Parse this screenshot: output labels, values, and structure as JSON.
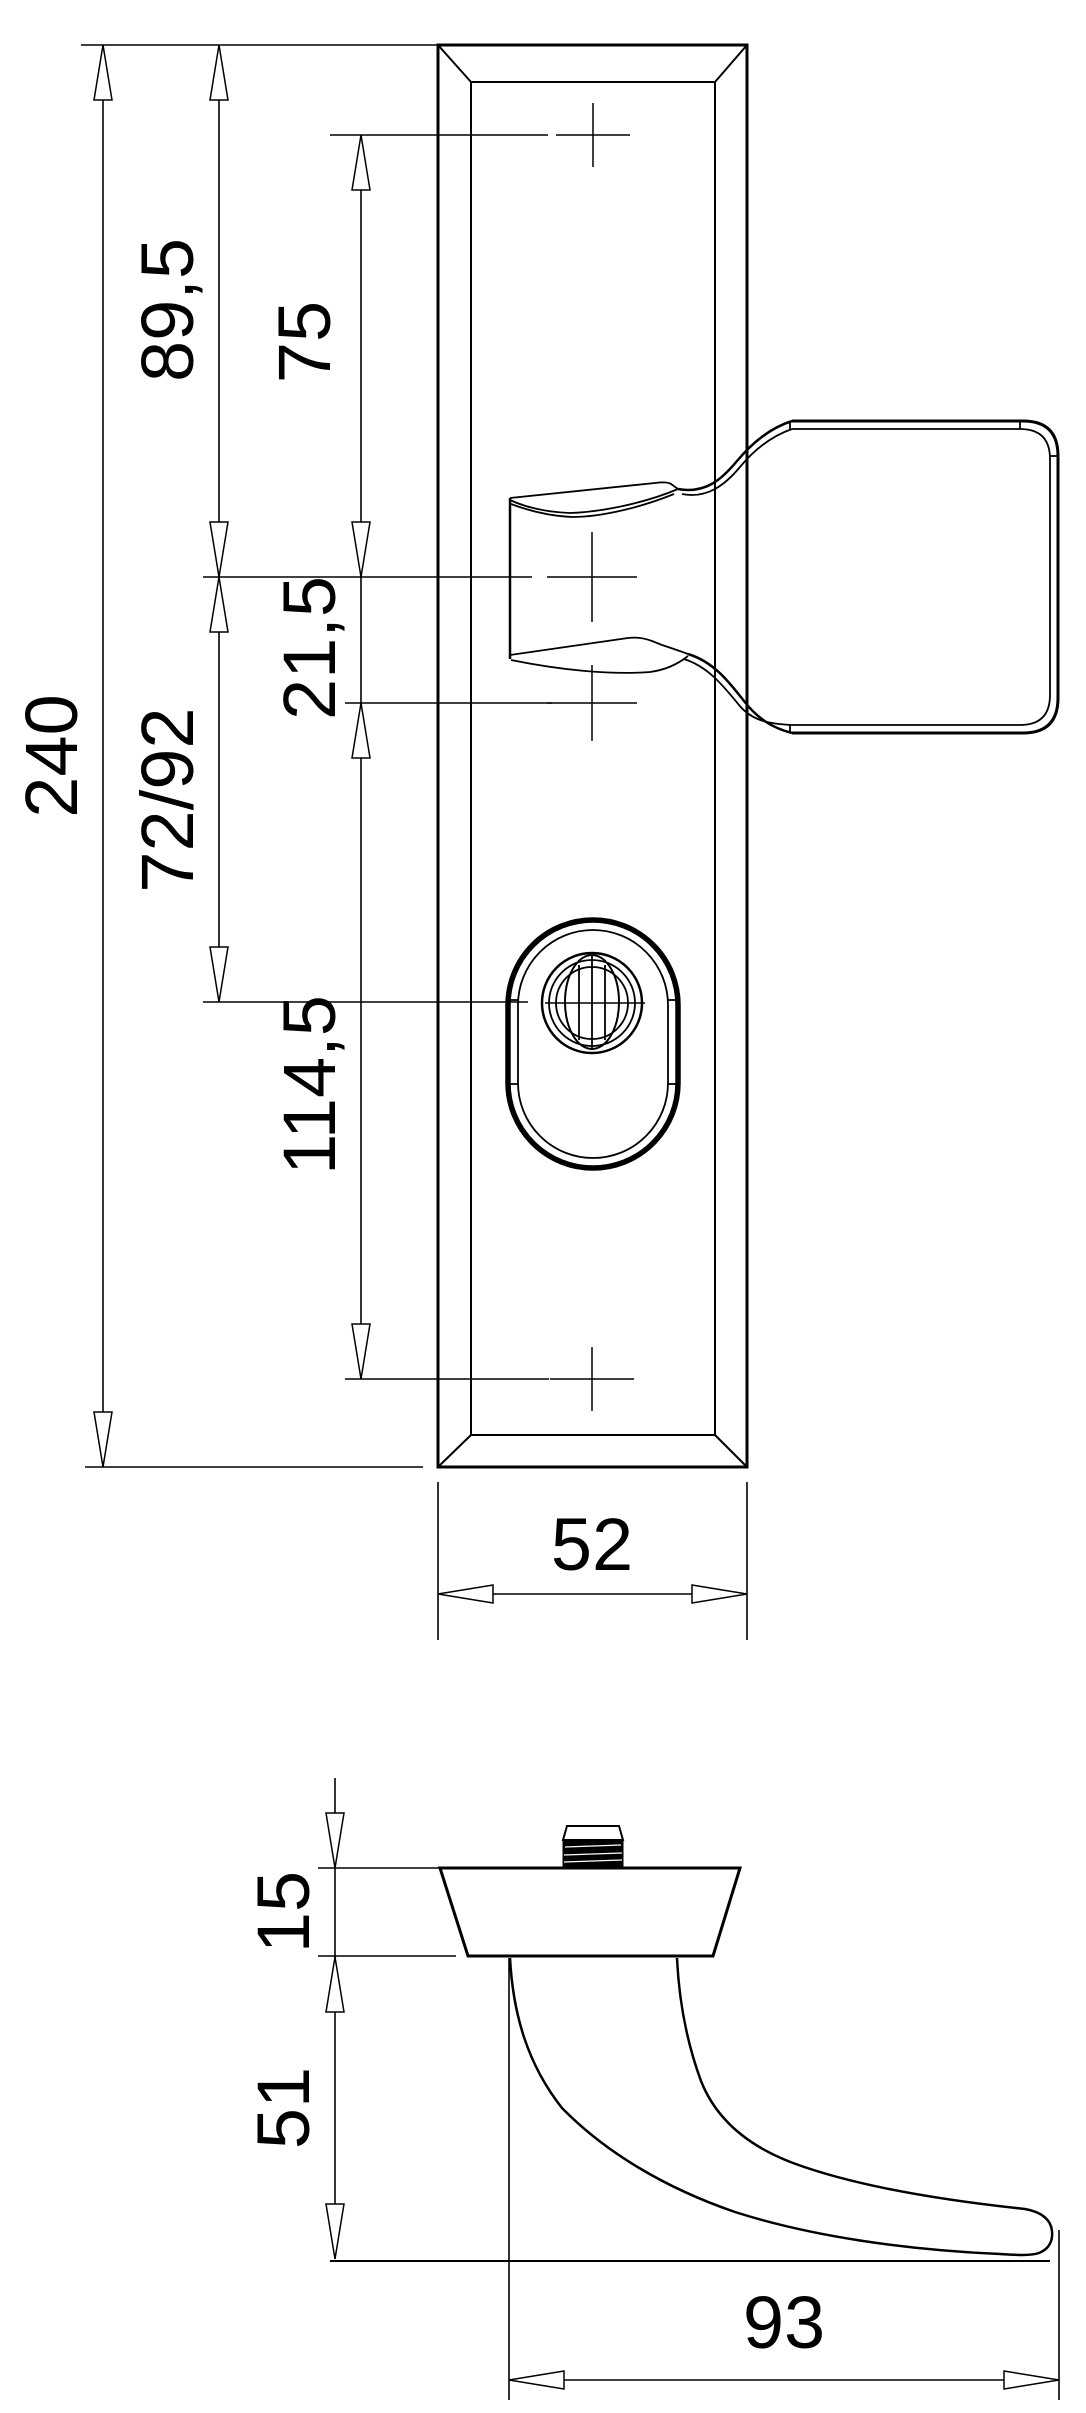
{
  "drawing": {
    "kind": "technical-dimension-drawing",
    "subject": "security door handle with long backplate and cylinder rosette",
    "units": "mm",
    "views": {
      "front": "front view of backplate with handle and rosette",
      "side": "side view of handle with rose"
    }
  },
  "colors": {
    "line": "#000000",
    "background": "#ffffff"
  },
  "dims": {
    "front": {
      "h240": "240",
      "h89_5": "89,5",
      "h75": "75",
      "h21_5": "21,5",
      "h72_92": "72/92",
      "h114_5": "114,5",
      "w52": "52"
    },
    "side": {
      "t15": "15",
      "p51": "51",
      "l93": "93"
    }
  }
}
